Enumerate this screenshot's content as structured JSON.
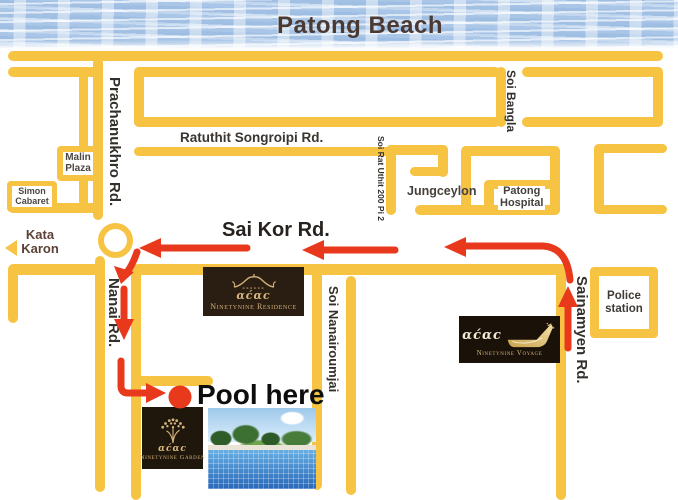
{
  "beach": {
    "title": "Patong Beach"
  },
  "roads": {
    "prachanukhro": "Prachanukhro Rd.",
    "ratuthit": "Ratuthit Songroipi Rd.",
    "soi_bangla": "Soi Bangla",
    "soi_rat_uthit": "Soi Rat Uthit 200 Pi 2",
    "sai_kor": "Sai Kor Rd.",
    "nanai": "Nanai Rd.",
    "soi_nanairoumjai": "Soi Nanairoumjai",
    "sainamyen": "Sainamyen Rd."
  },
  "places": {
    "malin_plaza": {
      "line1": "Malin",
      "line2": "Plaza"
    },
    "simon_cabaret": {
      "line1": "Simon",
      "line2": "Cabaret"
    },
    "jungceylon": "Jungceylon",
    "patong_hospital": {
      "line1": "Patong",
      "line2": "Hospital"
    },
    "police_station": {
      "line1": "Police",
      "line2": "station"
    },
    "kata_karon": {
      "line1": "Kata",
      "line2": "Karon"
    }
  },
  "marker": {
    "label": "Pool here"
  },
  "logos": {
    "residence": {
      "name": "Ninetynine Residence",
      "mark": "αϲ́αϲ"
    },
    "voyage": {
      "name": "Ninetynine Voyage",
      "mark": "αϲ́αϲ"
    },
    "garden": {
      "name": "Ninetynine Garden",
      "mark": "αϲ́αϲ"
    }
  },
  "colors": {
    "road": "#F7C342",
    "route_arrow": "#E8391C",
    "beach_title": "#4B3A33",
    "logo_gold": "#D2B079",
    "brand_box": "#241A10"
  }
}
